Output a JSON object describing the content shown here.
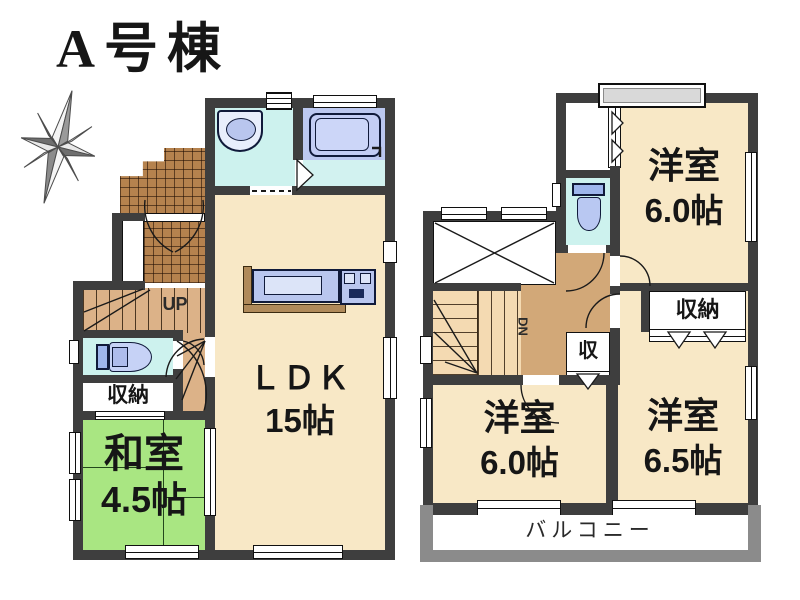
{
  "title": "A号棟",
  "floor1": {
    "ldk": {
      "name": "ＬＤＫ",
      "size": "15帖"
    },
    "washitsu": {
      "name": "和室",
      "size": "4.5帖"
    },
    "storage": {
      "label": "収納"
    },
    "stairs": {
      "label": "UP"
    }
  },
  "floor2": {
    "bedroom_north": {
      "name": "洋室",
      "size": "6.0帖"
    },
    "bedroom_southwest": {
      "name": "洋室",
      "size": "6.0帖"
    },
    "bedroom_southeast": {
      "name": "洋室",
      "size": "6.5帖"
    },
    "closet": {
      "label": "収納"
    },
    "closet_small": {
      "label": "収"
    },
    "stairs": {
      "label": "DN"
    },
    "balcony": {
      "label": "バルコニー"
    }
  },
  "colors": {
    "wall": "#3e3e3e",
    "ldk_fill": "#f8e8c6",
    "tatami_fill": "#a9e682",
    "wet_room_fill": "#cdf2ee",
    "bath_fill": "#bcc8f0",
    "entry_tile": "#b5824e",
    "stair_fill": "#dcb288",
    "hall_fill": "#d2a878",
    "stair2_fill": "#f4dab2",
    "balcony_wall": "#8b8b8b",
    "fixture_fill": "#b9c6ee",
    "window_gray": "#d9d9d9"
  }
}
